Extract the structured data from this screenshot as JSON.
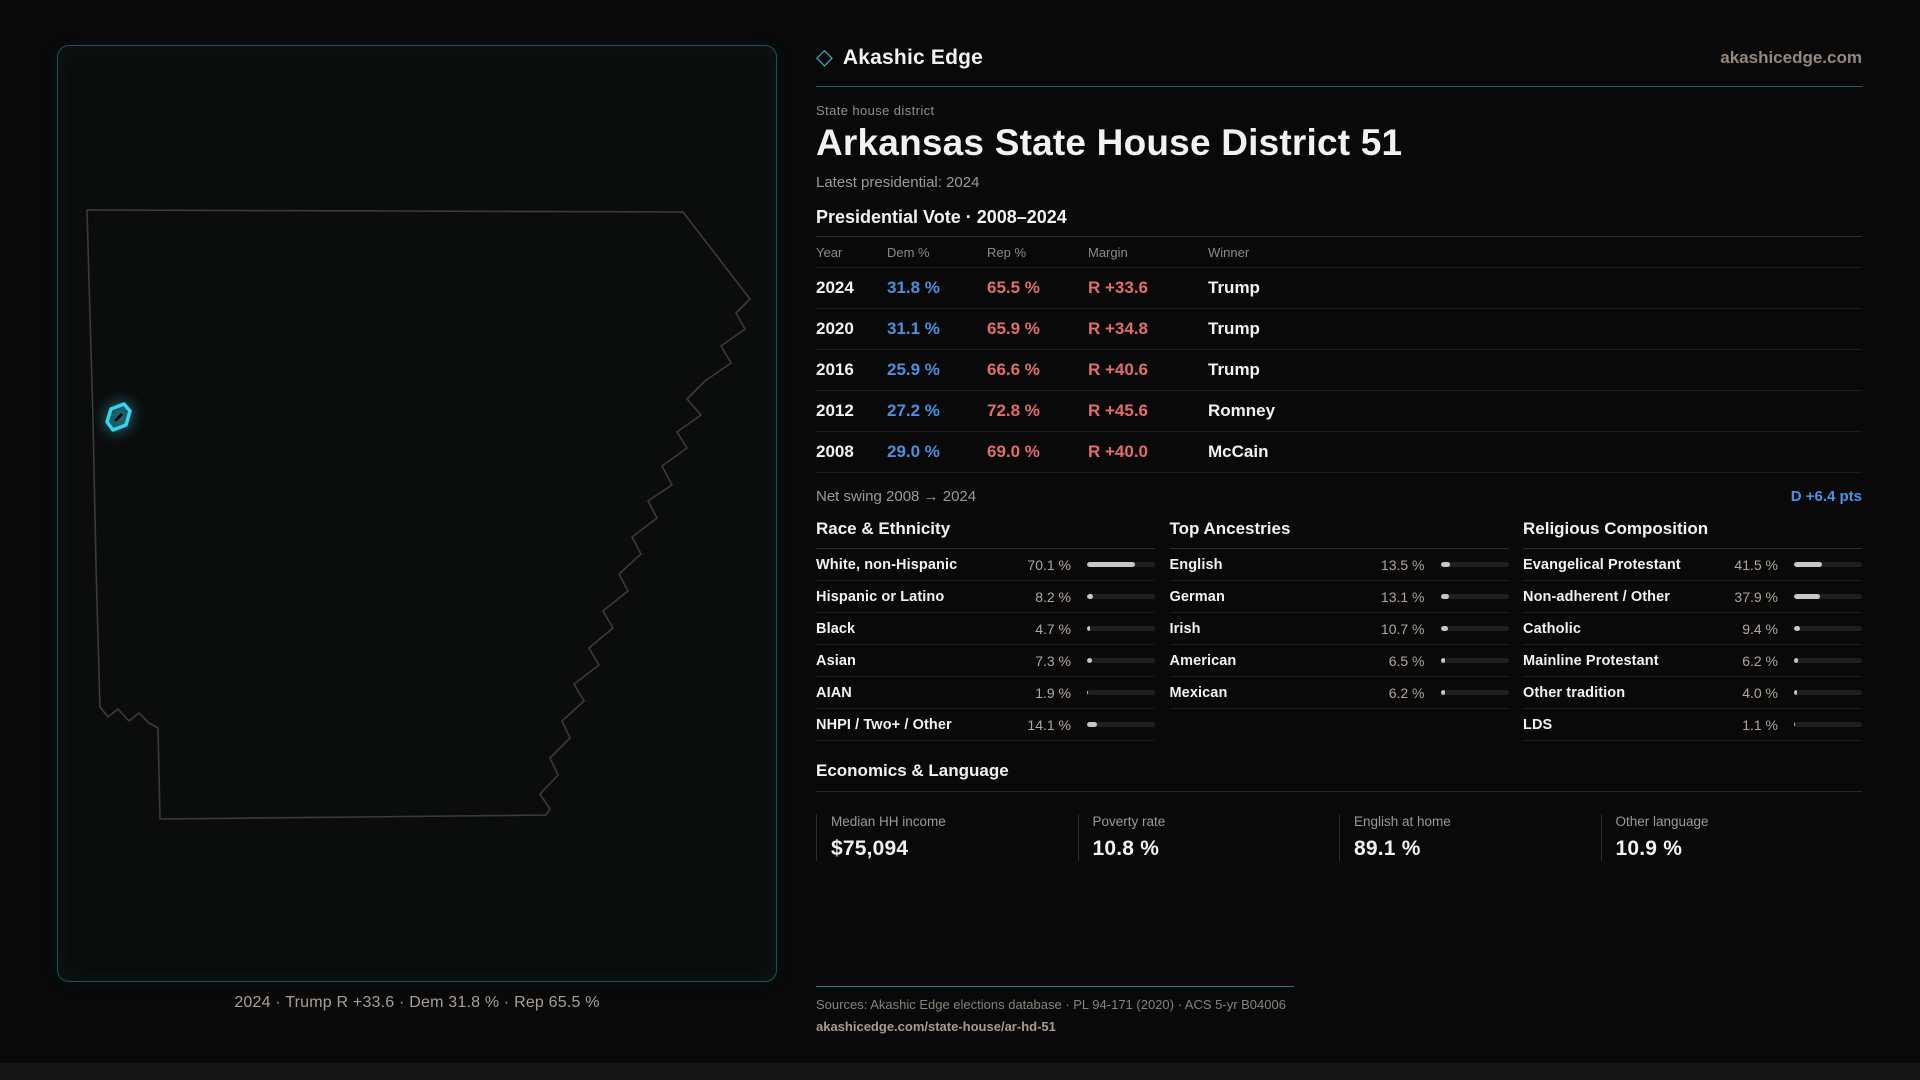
{
  "brand": {
    "name": "Akashic Edge",
    "domain": "akashicedge.com"
  },
  "page": {
    "eyebrow": "State house district",
    "title": "Arkansas State House District 51",
    "latest_label": "Latest presidential: 2024"
  },
  "vote_table": {
    "title": "Presidential Vote · 2008–2024",
    "columns": [
      "Year",
      "Dem %",
      "Rep %",
      "Margin",
      "Winner"
    ],
    "rows": [
      {
        "year": "2024",
        "dem": "31.8 %",
        "rep": "65.5 %",
        "margin": "R +33.6",
        "winner": "Trump"
      },
      {
        "year": "2020",
        "dem": "31.1 %",
        "rep": "65.9 %",
        "margin": "R +34.8",
        "winner": "Trump"
      },
      {
        "year": "2016",
        "dem": "25.9 %",
        "rep": "66.6 %",
        "margin": "R +40.6",
        "winner": "Trump"
      },
      {
        "year": "2012",
        "dem": "27.2 %",
        "rep": "72.8 %",
        "margin": "R +45.6",
        "winner": "Romney"
      },
      {
        "year": "2008",
        "dem": "29.0 %",
        "rep": "69.0 %",
        "margin": "R +40.0",
        "winner": "McCain"
      }
    ],
    "net_swing_label": "Net swing 2008 → 2024",
    "net_swing_value": "D +6.4 pts"
  },
  "demographics": [
    {
      "key": "race",
      "title": "Race & Ethnicity",
      "rows": [
        {
          "label": "White, non-Hispanic",
          "value": "70.1 %",
          "pct": 70.1
        },
        {
          "label": "Hispanic or Latino",
          "value": "8.2 %",
          "pct": 8.2
        },
        {
          "label": "Black",
          "value": "4.7 %",
          "pct": 4.7
        },
        {
          "label": "Asian",
          "value": "7.3 %",
          "pct": 7.3
        },
        {
          "label": "AIAN",
          "value": "1.9 %",
          "pct": 1.9
        },
        {
          "label": "NHPI / Two+ / Other",
          "value": "14.1 %",
          "pct": 14.1
        }
      ]
    },
    {
      "key": "ancestries",
      "title": "Top Ancestries",
      "rows": [
        {
          "label": "English",
          "value": "13.5 %",
          "pct": 13.5
        },
        {
          "label": "German",
          "value": "13.1 %",
          "pct": 13.1
        },
        {
          "label": "Irish",
          "value": "10.7 %",
          "pct": 10.7
        },
        {
          "label": "American",
          "value": "6.5 %",
          "pct": 6.5
        },
        {
          "label": "Mexican",
          "value": "6.2 %",
          "pct": 6.2
        }
      ]
    },
    {
      "key": "religion",
      "title": "Religious Composition",
      "rows": [
        {
          "label": "Evangelical Protestant",
          "value": "41.5 %",
          "pct": 41.5
        },
        {
          "label": "Non-adherent / Other",
          "value": "37.9 %",
          "pct": 37.9
        },
        {
          "label": "Catholic",
          "value": "9.4 %",
          "pct": 9.4
        },
        {
          "label": "Mainline Protestant",
          "value": "6.2 %",
          "pct": 6.2
        },
        {
          "label": "Other tradition",
          "value": "4.0 %",
          "pct": 4.0
        },
        {
          "label": "LDS",
          "value": "1.1 %",
          "pct": 1.1
        }
      ]
    }
  ],
  "economics": {
    "title": "Economics & Language",
    "stats": [
      {
        "label": "Median HH income",
        "value": "$75,094"
      },
      {
        "label": "Poverty rate",
        "value": "10.8 %"
      },
      {
        "label": "English at home",
        "value": "89.1 %"
      },
      {
        "label": "Other language",
        "value": "10.9 %"
      }
    ]
  },
  "map": {
    "caption": "2024 · Trump R +33.6 · Dem 31.8 % · Rep 65.5 %"
  },
  "footer": {
    "sources": "Sources: Akashic Edge elections database · PL 94-171 (2020) · ACS 5-yr B04006",
    "permalink": "akashicedge.com/state-house/ar-hd-51"
  },
  "colors": {
    "dem_blue": "#4e90dd",
    "rep_red": "#e26d6d",
    "swing_blue": "#4b93e8",
    "accent_cyan": "#35d6f0",
    "panel_border_teal": "#1d505b",
    "value_tan": "#b2a69b"
  }
}
